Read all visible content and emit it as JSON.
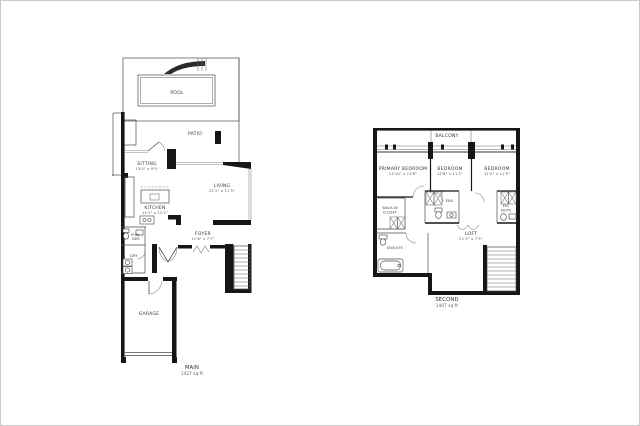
{
  "plans": {
    "main": {
      "floor_label": "MAIN",
      "area_label": "1427 sq ft",
      "rooms": {
        "pool": {
          "name": "POOL"
        },
        "patio": {
          "name": "PATIO"
        },
        "sitting": {
          "name": "SITTING",
          "dims": "13'0\" x 9'5\""
        },
        "living": {
          "name": "LIVING",
          "dims": "21'2\" x 11'5\""
        },
        "kitchen": {
          "name": "KITCHEN",
          "dims": "14'1\" x 12'2\""
        },
        "powder": {
          "name_line1": "POW-",
          "name_line2": "DER"
        },
        "laundry": {
          "name": "DRY"
        },
        "foyer": {
          "name": "FOYER",
          "dims": "11'6\" x 7'7\""
        },
        "garage": {
          "name": "GARAGE"
        }
      }
    },
    "second": {
      "floor_label": "SECOND",
      "area_label": "1407 sq ft",
      "rooms": {
        "balcony": {
          "name": "BALCONY"
        },
        "primary_bedroom": {
          "name": "PRIMARY BEDROOM",
          "dims": "13'10\" x 13'8\""
        },
        "bedroom_2": {
          "name": "BEDROOM",
          "dims": "12'8\" x 11'2\""
        },
        "bedroom_3": {
          "name": "BEDROOM",
          "dims": "11'5\" x 11'5\""
        },
        "walk_in_closet": {
          "name_line1": "WALK-IN",
          "name_line2": "CLOSET"
        },
        "ensuite_middle": {
          "name": "ENS."
        },
        "ensuite_right": {
          "name_line1": "EN-",
          "name_line2": "SUITE"
        },
        "ensuite_primary": {
          "name": "ENSUITE"
        },
        "loft": {
          "name": "LOFT",
          "dims": "21'3\" x 7'5\""
        }
      }
    }
  }
}
